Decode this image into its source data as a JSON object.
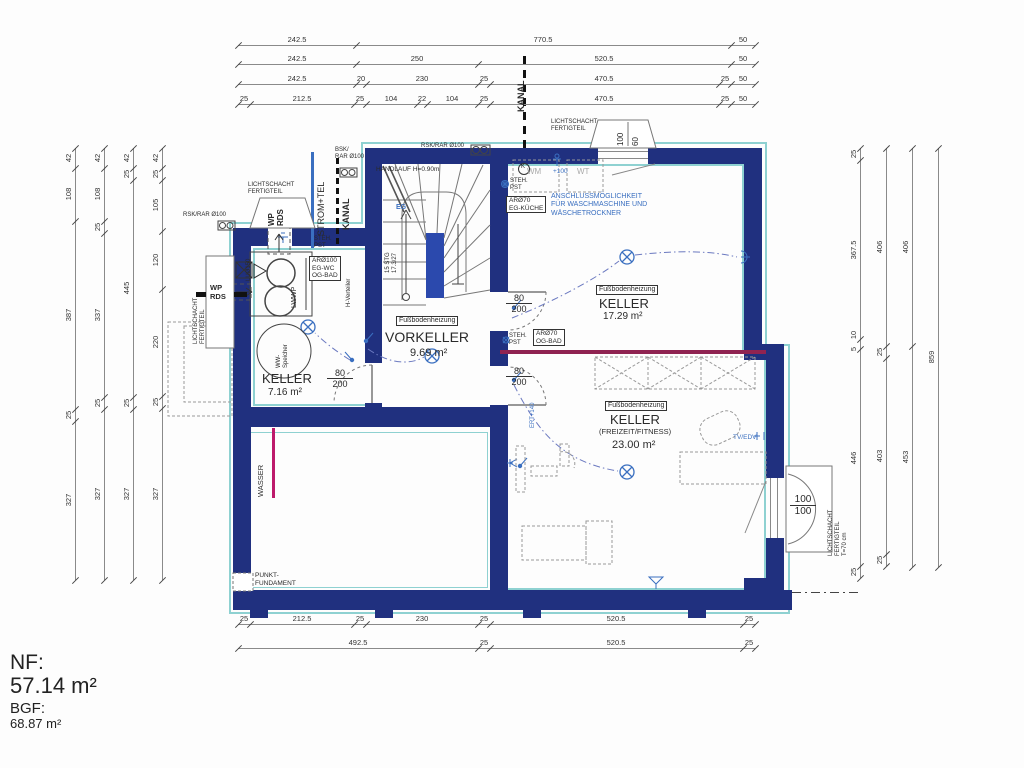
{
  "title_block": {
    "nf_label": "NF:",
    "nf_value": "57.14 m²",
    "bgf_label": "BGF:",
    "bgf_value": "68.87 m²"
  },
  "colors": {
    "wall": "#20307f",
    "insulation": "#8ed1d1",
    "beam": "#8f2351",
    "water": "#bd1a6b",
    "electric": "#3a6fc0"
  },
  "rooms": [
    {
      "label": "KELLER",
      "area": "7.16 m²"
    },
    {
      "label": "VORKELLER",
      "area": "9.69 m²",
      "heating": "Fußbodenheizung"
    },
    {
      "label": "KELLER",
      "area": "17.29 m²",
      "heating": "Fußbodenheizung"
    },
    {
      "label": "KELLER",
      "sub": "(FREIZEIT/FITNESS)",
      "area": "23.00 m²",
      "heating": "Fußbodenheizung"
    }
  ],
  "annotations": [
    {
      "n": "kanal-top-label",
      "t": "KANAL",
      "x": 516,
      "y": 112,
      "fs": 9,
      "cls": "v bold"
    },
    {
      "n": "strom-tel-label",
      "t": "STROM+TEL",
      "x": 316,
      "y": 236,
      "fs": 9,
      "cls": "v"
    },
    {
      "n": "kanal-left-label",
      "t": "KANAL",
      "x": 341,
      "y": 230,
      "fs": 9,
      "cls": "v bold"
    },
    {
      "n": "bsk-rar-label",
      "t": "BSK/\nRAR Ø100",
      "x": 335,
      "y": 147,
      "fs": 6,
      "cls": ""
    },
    {
      "n": "rsk-rar-top-label",
      "t": "RSK/RAR Ø100",
      "x": 421,
      "y": 143,
      "fs": 6,
      "cls": ""
    },
    {
      "n": "rsk-rar-left-label",
      "t": "RSK/RAR Ø100",
      "x": 183,
      "y": 212,
      "fs": 6,
      "cls": ""
    },
    {
      "n": "lichtschacht-topleft-label",
      "t": "LICHTSCHACHT\nFERTIGTEIL",
      "x": 248,
      "y": 182,
      "fs": 6,
      "cls": ""
    },
    {
      "n": "wp-rds-vertical-label",
      "t": "WP\nRDS",
      "x": 267,
      "y": 226,
      "fs": 8,
      "cls": "v bold"
    },
    {
      "n": "wp-rds-left-label",
      "t": "WP\nRDS",
      "x": 210,
      "y": 284,
      "fs": 7.5,
      "cls": "bold"
    },
    {
      "n": "lichtschacht-west-label",
      "t": "LICHTSCHACHT\nFERTIGTEIL",
      "x": 193,
      "y": 344,
      "fs": 6,
      "cls": "v"
    },
    {
      "n": "lu150-label",
      "t": "LUØ150",
      "x": 246,
      "y": 281,
      "fs": 6,
      "cls": "v"
    },
    {
      "n": "lwwp-label",
      "t": "LWWP",
      "x": 291,
      "y": 308,
      "fs": 7,
      "cls": "v"
    },
    {
      "n": "steh-pst-label-1",
      "t": "STEH.\nPST",
      "x": 314,
      "y": 236,
      "fs": 6,
      "cls": ""
    },
    {
      "n": "ar100-egwc-box",
      "t": "ARØ100\nEG-WC\nOG-BAD",
      "x": 309,
      "y": 256,
      "fs": 6.5,
      "cls": "boxed"
    },
    {
      "n": "h-verteiler-label",
      "t": "H-Verteiler",
      "x": 346,
      "y": 307,
      "fs": 6,
      "cls": "v"
    },
    {
      "n": "ww-speicher-label",
      "t": "WW-\nSpeicher",
      "x": 276,
      "y": 368,
      "fs": 6,
      "cls": "v"
    },
    {
      "n": "keller-716-label",
      "t": "KELLER",
      "x": 262,
      "y": 371,
      "fs": 13,
      "cls": ""
    },
    {
      "n": "keller-716-area",
      "t": "7.16 m²",
      "x": 268,
      "y": 387,
      "fs": 10,
      "cls": ""
    },
    {
      "n": "handlauf-label",
      "t": "HANDLAUF H=0.90m",
      "x": 376,
      "y": 166,
      "fs": 6.5,
      "cls": ""
    },
    {
      "n": "stg-label",
      "t": "15 STG\n17.3/27",
      "x": 385,
      "y": 273,
      "fs": 6,
      "cls": "v"
    },
    {
      "n": "eg-label",
      "t": "EG",
      "x": 396,
      "y": 204,
      "fs": 7,
      "cls": "blue bold"
    },
    {
      "n": "fbh-vorkeller-box",
      "t": "Fußbodenheizung",
      "x": 396,
      "y": 316,
      "fs": 7,
      "cls": "boxed"
    },
    {
      "n": "vorkeller-label",
      "t": "VORKELLER",
      "x": 385,
      "y": 329,
      "fs": 14,
      "cls": ""
    },
    {
      "n": "vorkeller-area",
      "t": "9.69 m²",
      "x": 410,
      "y": 347,
      "fs": 11,
      "cls": ""
    },
    {
      "n": "wm-label",
      "t": "WM",
      "x": 527,
      "y": 167,
      "fs": 8,
      "cls": "gray"
    },
    {
      "n": "wt-label",
      "t": "WT",
      "x": 577,
      "y": 167,
      "fs": 8,
      "cls": "gray"
    },
    {
      "n": "plus100-label",
      "t": "+100",
      "x": 553,
      "y": 168,
      "fs": 6.5,
      "cls": "blue"
    },
    {
      "n": "anschluss-label",
      "t": "ANSCHLUSSMÖGLICHKEIT\nFÜR WASCHMASCHINE UND\nWÄSCHETROCKNER",
      "x": 551,
      "y": 193,
      "fs": 7,
      "cls": "blue"
    },
    {
      "n": "steh-pst-label-2",
      "t": "STEH.\nPST",
      "x": 510,
      "y": 178,
      "fs": 6,
      "cls": ""
    },
    {
      "n": "ar70-kueche-box",
      "t": "ARØ70\nEG-KÜCHE",
      "x": 506,
      "y": 196,
      "fs": 6.5,
      "cls": "boxed"
    },
    {
      "n": "k-symbol-label",
      "t": "K",
      "x": 521,
      "y": 164,
      "fs": 6,
      "cls": ""
    },
    {
      "n": "fbh-keller1729-box",
      "t": "Fußbodenheizung",
      "x": 596,
      "y": 285,
      "fs": 7,
      "cls": "boxed"
    },
    {
      "n": "keller-1729-label",
      "t": "KELLER",
      "x": 599,
      "y": 296,
      "fs": 13,
      "cls": ""
    },
    {
      "n": "keller-1729-area",
      "t": "17.29 m²",
      "x": 603,
      "y": 311,
      "fs": 10,
      "cls": ""
    },
    {
      "n": "steh-pst-label-3",
      "t": "STEH.\nPST",
      "x": 509,
      "y": 333,
      "fs": 6,
      "cls": ""
    },
    {
      "n": "ar70-ogbad-box",
      "t": "ARØ70\nOG-BAD",
      "x": 533,
      "y": 329,
      "fs": 6.5,
      "cls": "boxed"
    },
    {
      "n": "fbh-keller2300-box",
      "t": "Fußbodenheizung",
      "x": 605,
      "y": 401,
      "fs": 7,
      "cls": "boxed"
    },
    {
      "n": "keller-2300-label",
      "t": "KELLER",
      "x": 610,
      "y": 412,
      "fs": 13,
      "cls": ""
    },
    {
      "n": "keller-2300-sub",
      "t": "(FREIZEIT/FITNESS)",
      "x": 599,
      "y": 428,
      "fs": 7.5,
      "cls": ""
    },
    {
      "n": "keller-2300-area",
      "t": "23.00 m²",
      "x": 612,
      "y": 439,
      "fs": 11,
      "cls": ""
    },
    {
      "n": "ert140-label",
      "t": "ERT+140",
      "x": 530,
      "y": 428,
      "fs": 6,
      "cls": "v blue"
    },
    {
      "n": "tv-edv-label",
      "t": "TV/EDV",
      "x": 733,
      "y": 434,
      "fs": 6.5,
      "cls": "blue"
    },
    {
      "n": "wasser-label",
      "t": "WASSER",
      "x": 257,
      "y": 497,
      "fs": 7.5,
      "cls": "v"
    },
    {
      "n": "punkt-fundament-label",
      "t": "PUNKT-\nFUNDAMENT",
      "x": 255,
      "y": 572,
      "fs": 6.5,
      "cls": ""
    },
    {
      "n": "lichtschacht-top-label",
      "t": "LICHTSCHACHT\nFERTIGTEIL",
      "x": 551,
      "y": 119,
      "fs": 6,
      "cls": ""
    },
    {
      "n": "lichtschacht-top-100",
      "t": "100",
      "x": 616,
      "y": 146,
      "fs": 8,
      "cls": "v"
    },
    {
      "n": "lichtschacht-top-60",
      "t": "60",
      "x": 631,
      "y": 146,
      "fs": 8,
      "cls": "v"
    },
    {
      "n": "lichtschacht-right-label",
      "t": "LICHTSCHACHT\nFERTIGTEIL\nT=70 cm",
      "x": 828,
      "y": 556,
      "fs": 6,
      "cls": "v"
    }
  ],
  "fracs": [
    {
      "n": "door-left-dim",
      "top": "80",
      "bottom": "200",
      "x": 327,
      "y": 368,
      "fs": 9
    },
    {
      "n": "door-keller1729-dim",
      "top": "80",
      "bottom": "200",
      "x": 506,
      "y": 293,
      "fs": 9
    },
    {
      "n": "door-keller2300-dim",
      "top": "80",
      "bottom": "200",
      "x": 506,
      "y": 366,
      "fs": 9
    },
    {
      "n": "window-right-dim",
      "top": "100",
      "bottom": "100",
      "x": 790,
      "y": 494,
      "fs": 10
    }
  ],
  "dimensions": [
    {
      "n": "top-row-1",
      "dir": "h",
      "at": 45,
      "ticks": [
        238,
        356,
        731,
        755
      ],
      "labels": [
        {
          "c": 297,
          "t": "242.5"
        },
        {
          "c": 543,
          "t": "770.5"
        },
        {
          "c": 743,
          "t": "50"
        }
      ]
    },
    {
      "n": "top-row-2",
      "dir": "h",
      "at": 64,
      "ticks": [
        238,
        356,
        478,
        731,
        755
      ],
      "labels": [
        {
          "c": 297,
          "t": "242.5"
        },
        {
          "c": 417,
          "t": "250"
        },
        {
          "c": 604,
          "t": "520.5"
        },
        {
          "c": 743,
          "t": "50"
        }
      ]
    },
    {
      "n": "top-row-3",
      "dir": "h",
      "at": 84,
      "ticks": [
        238,
        356,
        366,
        478,
        490,
        719,
        731,
        755
      ],
      "labels": [
        {
          "c": 297,
          "t": "242.5"
        },
        {
          "c": 361,
          "t": "20"
        },
        {
          "c": 422,
          "t": "230"
        },
        {
          "c": 484,
          "t": "25"
        },
        {
          "c": 604,
          "t": "470.5"
        },
        {
          "c": 725,
          "t": "25"
        },
        {
          "c": 743,
          "t": "50"
        }
      ]
    },
    {
      "n": "top-row-4",
      "dir": "h",
      "at": 104,
      "ticks": [
        238,
        250,
        354,
        366,
        417,
        427,
        478,
        490,
        719,
        731,
        755
      ],
      "labels": [
        {
          "c": 244,
          "t": "25"
        },
        {
          "c": 302,
          "t": "212.5"
        },
        {
          "c": 360,
          "t": "25"
        },
        {
          "c": 391,
          "t": "104"
        },
        {
          "c": 422,
          "t": "22"
        },
        {
          "c": 452,
          "t": "104"
        },
        {
          "c": 484,
          "t": "25"
        },
        {
          "c": 604,
          "t": "470.5"
        },
        {
          "c": 725,
          "t": "25"
        },
        {
          "c": 743,
          "t": "50"
        }
      ]
    },
    {
      "n": "bottom-row-1",
      "dir": "h",
      "at": 624,
      "ticks": [
        238,
        250,
        354,
        366,
        478,
        490,
        743,
        755
      ],
      "labels": [
        {
          "c": 244,
          "t": "25"
        },
        {
          "c": 302,
          "t": "212.5"
        },
        {
          "c": 360,
          "t": "25"
        },
        {
          "c": 422,
          "t": "230"
        },
        {
          "c": 484,
          "t": "25"
        },
        {
          "c": 616,
          "t": "520.5"
        },
        {
          "c": 749,
          "t": "25"
        }
      ]
    },
    {
      "n": "bottom-row-2",
      "dir": "h",
      "at": 648,
      "ticks": [
        238,
        478,
        490,
        743,
        755
      ],
      "labels": [
        {
          "c": 358,
          "t": "492.5"
        },
        {
          "c": 484,
          "t": "25"
        },
        {
          "c": 616,
          "t": "520.5"
        },
        {
          "c": 749,
          "t": "25"
        }
      ]
    },
    {
      "n": "left-col-1",
      "dir": "v",
      "at": 75,
      "ticks": [
        148,
        168,
        221,
        409,
        421,
        580
      ],
      "labels": [
        {
          "c": 158,
          "t": "42"
        },
        {
          "c": 194,
          "t": "108"
        },
        {
          "c": 315,
          "t": "387"
        },
        {
          "c": 415,
          "t": "25"
        },
        {
          "c": 500,
          "t": "327"
        }
      ]
    },
    {
      "n": "left-col-2",
      "dir": "v",
      "at": 104,
      "ticks": [
        148,
        168,
        221,
        233,
        397,
        409,
        580
      ],
      "labels": [
        {
          "c": 158,
          "t": "42"
        },
        {
          "c": 194,
          "t": "108"
        },
        {
          "c": 227,
          "t": "25"
        },
        {
          "c": 315,
          "t": "337"
        },
        {
          "c": 403,
          "t": "25"
        },
        {
          "c": 494,
          "t": "327"
        }
      ]
    },
    {
      "n": "left-col-3",
      "dir": "v",
      "at": 133,
      "ticks": [
        148,
        168,
        180,
        397,
        409,
        580
      ],
      "labels": [
        {
          "c": 158,
          "t": "42"
        },
        {
          "c": 174,
          "t": "25"
        },
        {
          "c": 288,
          "t": "445"
        },
        {
          "c": 403,
          "t": "25"
        },
        {
          "c": 494,
          "t": "327"
        }
      ]
    },
    {
      "n": "left-col-4",
      "dir": "v",
      "at": 162,
      "ticks": [
        148,
        168,
        180,
        231,
        289,
        396,
        408,
        580
      ],
      "labels": [
        {
          "c": 158,
          "t": "42"
        },
        {
          "c": 174,
          "t": "25"
        },
        {
          "c": 205,
          "t": "105"
        },
        {
          "c": 260,
          "t": "120"
        },
        {
          "c": 342,
          "t": "220"
        },
        {
          "c": 402,
          "t": "25"
        },
        {
          "c": 494,
          "t": "327"
        }
      ]
    },
    {
      "n": "right-col-1",
      "dir": "v",
      "at": 860,
      "ticks": [
        148,
        160,
        339,
        349,
        566,
        578
      ],
      "labels": [
        {
          "c": 154,
          "t": "25"
        },
        {
          "c": 250,
          "t": "367.5"
        },
        {
          "c": 335,
          "t": "10"
        },
        {
          "c": 349,
          "t": "5"
        },
        {
          "c": 458,
          "t": "446"
        },
        {
          "c": 572,
          "t": "25"
        }
      ]
    },
    {
      "n": "right-col-2",
      "dir": "v",
      "at": 886,
      "ticks": [
        148,
        346,
        358,
        554,
        566
      ],
      "labels": [
        {
          "c": 247,
          "t": "406"
        },
        {
          "c": 352,
          "t": "25"
        },
        {
          "c": 456,
          "t": "403"
        },
        {
          "c": 560,
          "t": "25"
        }
      ]
    },
    {
      "n": "right-col-3",
      "dir": "v",
      "at": 912,
      "ticks": [
        148,
        346,
        567
      ],
      "labels": [
        {
          "c": 247,
          "t": "406"
        },
        {
          "c": 457,
          "t": "453"
        }
      ]
    },
    {
      "n": "right-col-4",
      "dir": "v",
      "at": 938,
      "ticks": [
        148,
        567
      ],
      "labels": [
        {
          "c": 357,
          "t": "859"
        }
      ]
    }
  ]
}
